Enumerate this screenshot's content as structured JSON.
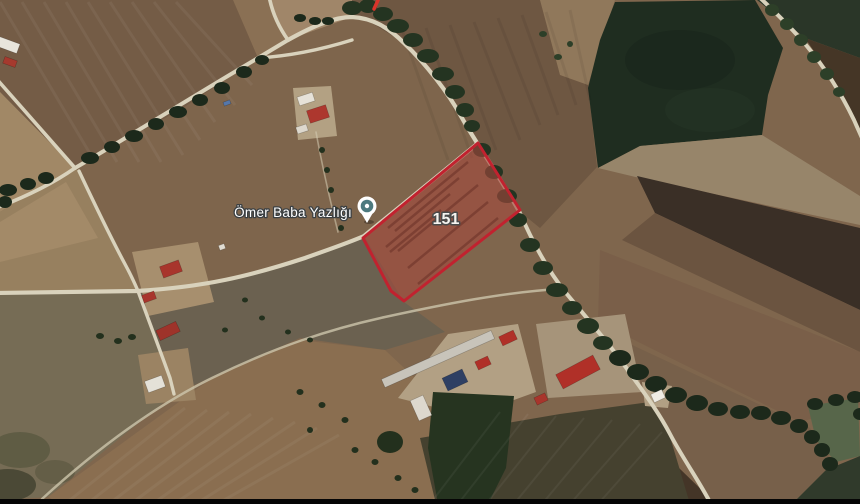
{
  "map": {
    "view": "satellite",
    "place": {
      "label": "Ömer Baba Yazlığı"
    },
    "parcel": {
      "number": "151",
      "outline_color": "#c1222f",
      "fill_color": "#a3493e"
    },
    "marker": {
      "icon": "place-marker-pin",
      "outer_color": "#ffffff",
      "inner_color": "#4d7a7f"
    },
    "colors": {
      "road": "#d9d2bc",
      "trees": "#202e1e",
      "dark_green_field": "#1f2d20",
      "plowed_field": "#745c46",
      "letterbox_bar": "#000000",
      "label_text": "#ffffff"
    }
  }
}
